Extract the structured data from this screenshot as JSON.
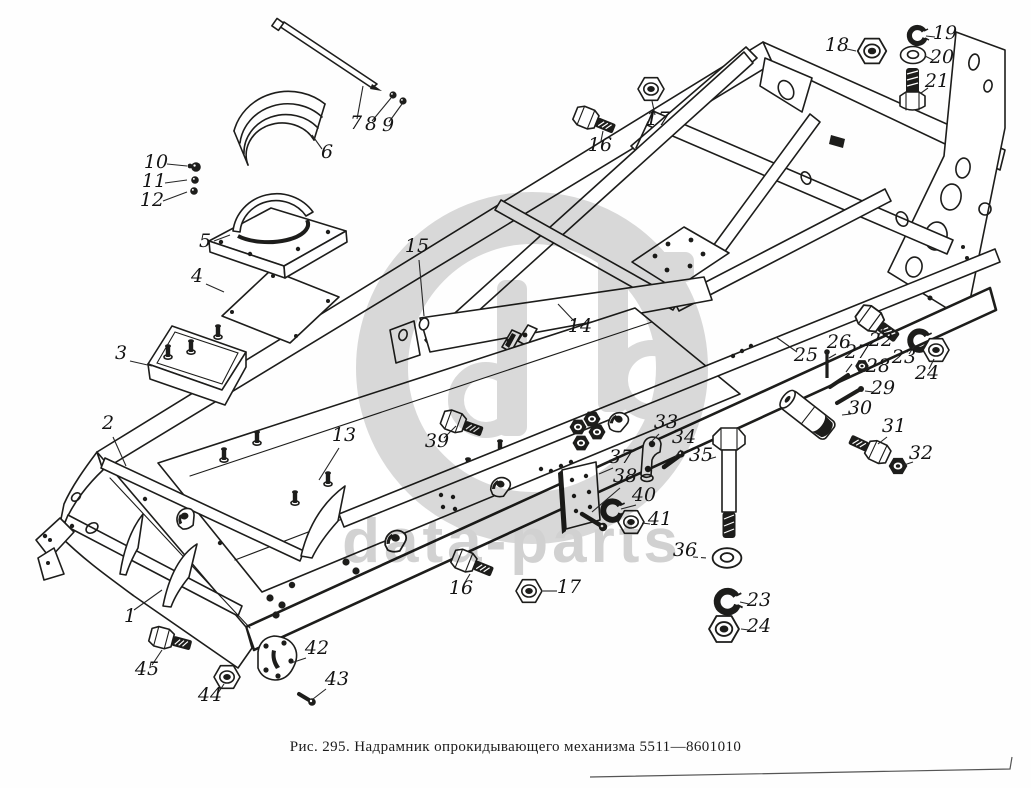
{
  "figure": {
    "caption": "Рис. 295. Надрамник опрокидывающего механизма 5511—8601010"
  },
  "watermark": {
    "text": "data-parts",
    "color": "#d9d9d9",
    "text_color": "#d2d2d2"
  },
  "diagram": {
    "ink_color": "#1d1d1b",
    "callouts": [
      {
        "label": "1"
      },
      {
        "label": "2"
      },
      {
        "label": "3"
      },
      {
        "label": "4"
      },
      {
        "label": "5"
      },
      {
        "label": "6"
      },
      {
        "label": "7"
      },
      {
        "label": "8"
      },
      {
        "label": "9"
      },
      {
        "label": "10"
      },
      {
        "label": "11"
      },
      {
        "label": "12"
      },
      {
        "label": "13"
      },
      {
        "label": "14"
      },
      {
        "label": "15"
      },
      {
        "label": "16"
      },
      {
        "label": "17"
      },
      {
        "label": "18"
      },
      {
        "label": "19"
      },
      {
        "label": "20"
      },
      {
        "label": "21"
      },
      {
        "label": "22"
      },
      {
        "label": "23"
      },
      {
        "label": "24"
      },
      {
        "label": "25"
      },
      {
        "label": "26"
      },
      {
        "label": "27"
      },
      {
        "label": "28"
      },
      {
        "label": "29"
      },
      {
        "label": "30"
      },
      {
        "label": "31"
      },
      {
        "label": "32"
      },
      {
        "label": "33"
      },
      {
        "label": "34"
      },
      {
        "label": "35"
      },
      {
        "label": "36"
      },
      {
        "label": "37"
      },
      {
        "label": "38"
      },
      {
        "label": "39"
      },
      {
        "label": "40"
      },
      {
        "label": "41"
      },
      {
        "label": "42"
      },
      {
        "label": "43"
      },
      {
        "label": "44"
      },
      {
        "label": "45"
      },
      {
        "label": "16"
      },
      {
        "label": "17"
      },
      {
        "label": "23"
      },
      {
        "label": "24"
      }
    ]
  }
}
